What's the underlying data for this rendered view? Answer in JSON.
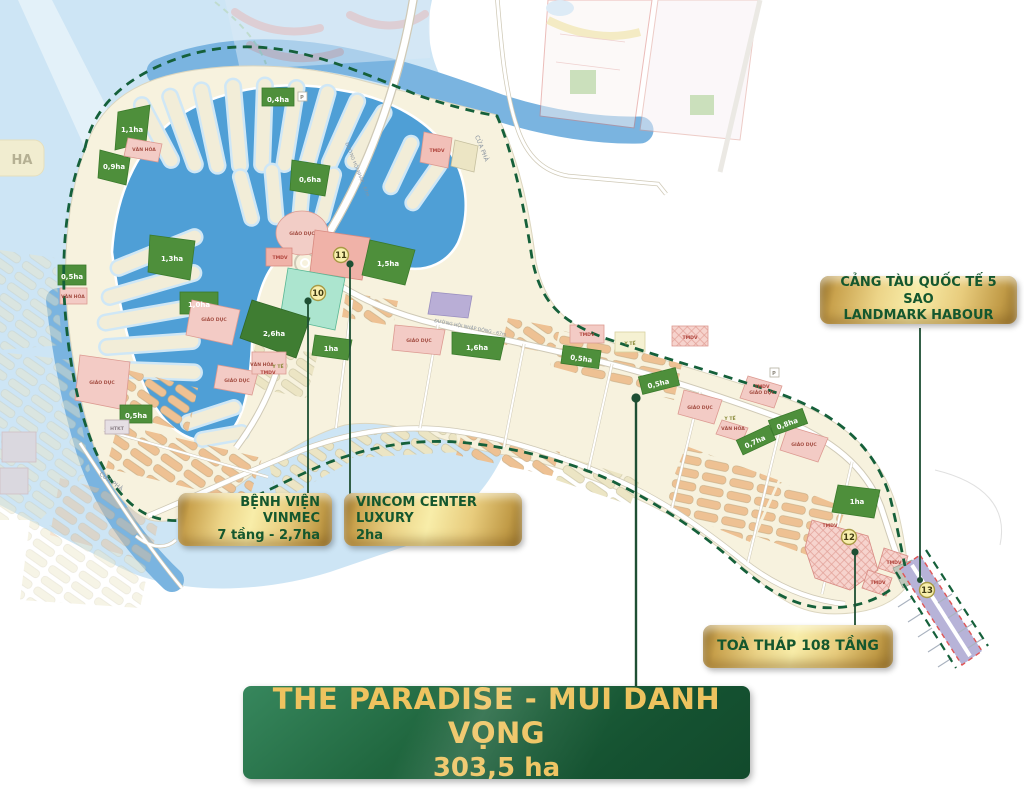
{
  "banner": {
    "line1": "THE PARADISE - MŨI DANH VỌNG",
    "line2": "303,5 ha"
  },
  "callouts": {
    "vinmec": {
      "line1": "BỆNH VIỆN VINMEC",
      "line2": "7 tầng - 2,7ha"
    },
    "vincom": {
      "line1": "VINCOM CENTER LUXURY",
      "line2": "2ha"
    },
    "harbour": {
      "line1": "CẢNG TÀU QUỐC TẾ 5 SAO",
      "line2": "LANDMARK HABOUR"
    },
    "tower": {
      "line1": "TOÀ THÁP 108 TẦNG"
    }
  },
  "markers": {
    "m10": "10",
    "m11": "11",
    "m12": "12",
    "m13": "13"
  },
  "map": {
    "edge_label": "HA",
    "ferry_label": "CỬA PHÀ",
    "road_label_1": "ĐƯỜNG HỘI NHẬP - 67m",
    "road_label_2": "ĐƯỜNG HỘI NHẬP ĐÔNG - 67m",
    "parking": "P",
    "areas": [
      "0,4ha",
      "1,1ha",
      "0,9ha",
      "0,6ha",
      "1,3ha",
      "0,5ha",
      "1,0ha",
      "2,6ha",
      "1,5ha",
      "1ha",
      "1,6ha",
      "0,5ha",
      "0,5ha",
      "0,5ha",
      "0,8ha",
      "0,7ha",
      "1ha"
    ],
    "zones": {
      "education": "GIÁO DỤC",
      "culture": "VĂN HÓA",
      "commerce": "TMDV",
      "medical": "Y TẾ",
      "infra": "HTKT"
    }
  },
  "colors": {
    "water": "#cde5f5",
    "canal": "#4f9fd6",
    "land": "#f7f2de",
    "boundary_green": "#15603a",
    "gold_marker": "#f8efad",
    "callout_text_green": "#14572e",
    "banner_green": "#1c5c38",
    "banner_gold": "#eec35f",
    "parcel_pink": "#f3cbc5",
    "parcel_green": "#4e8f3b",
    "parcel_mint": "#ace5cf",
    "parcel_salmon": "#f0b2a8",
    "pier_lavender": "#b7b3d8"
  }
}
